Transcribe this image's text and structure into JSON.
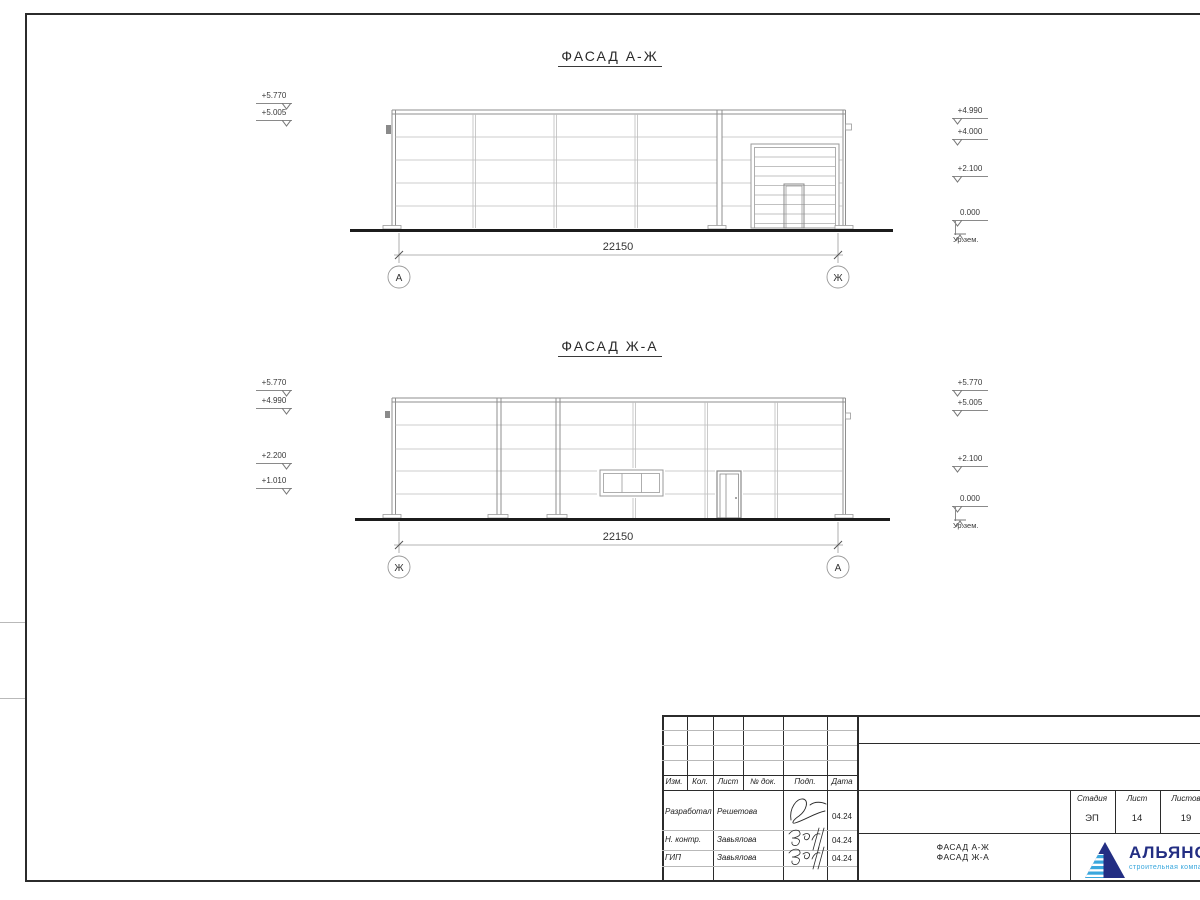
{
  "sheet": {
    "facade1": {
      "title": "ФАСАД А-Ж",
      "dimension": "22150",
      "grid_left": "А",
      "grid_right": "Ж",
      "marks_left": [
        "+5.770",
        "+5.005"
      ],
      "marks_right": [
        "+4.990",
        "+4.000",
        "+2.100",
        "0.000"
      ],
      "ground_label": "Ур.зем."
    },
    "facade2": {
      "title": "ФАСАД Ж-А",
      "dimension": "22150",
      "grid_left": "Ж",
      "grid_right": "А",
      "marks_left": [
        "+5.770",
        "+4.990",
        "+2.200",
        "+1.010"
      ],
      "marks_right": [
        "+5.770",
        "+5.005",
        "+2.100",
        "0.000"
      ],
      "ground_label": "Ур.зем."
    },
    "titleblock": {
      "change_header": [
        "Изм.",
        "Кол.",
        "Лист",
        "№ док.",
        "Подп.",
        "Дата"
      ],
      "sign_rows": [
        {
          "role": "Разработал",
          "name": "Решетова",
          "date": "04.24"
        },
        {
          "role": "Н. контр.",
          "name": "Завьялова",
          "date": "04.24"
        },
        {
          "role": "ГИП",
          "name": "Завьялова",
          "date": "04.24"
        }
      ],
      "stage_label": "Стадия",
      "sheet_label": "Лист",
      "sheets_label": "Листов",
      "stage_value": "ЭП",
      "sheet_value": "14",
      "sheets_value": "19",
      "doc_title_line1": "ФАСАД А-Ж",
      "doc_title_line2": "ФАСАД Ж-А",
      "logo": {
        "name": "АЛЬЯНС",
        "tagline": "строительная компания",
        "color": "#232e83",
        "accent": "#3aa7dd"
      }
    }
  }
}
